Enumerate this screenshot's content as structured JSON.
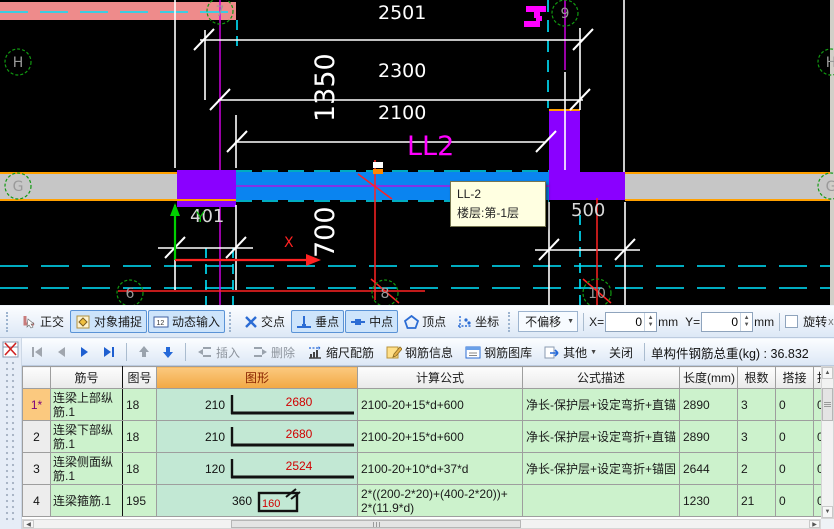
{
  "drawing": {
    "grid_labels": {
      "H_left": "H",
      "G_left": "G",
      "H_right": "H",
      "G_right": "G",
      "c6": "6",
      "c7": "7",
      "c8": "8",
      "c9": "9",
      "c10": "10"
    },
    "dimensions": {
      "top1": "2501",
      "top2": "2300",
      "top3": "2100",
      "vert1": "1350",
      "vert2": "700",
      "col_left": "401",
      "col_right": "500"
    },
    "beam_label": "LL2",
    "axis": {
      "x": "X",
      "y": "Y"
    },
    "tooltip": {
      "line1": "LL-2",
      "line2": "楼层:第-1层"
    },
    "colors": {
      "beam": "#0a84f0",
      "column": "#8a00ff",
      "wall": "#c6c6c6",
      "highlight_band": "#ee8b8b",
      "edge_orange": "#ffa000",
      "centerline": "#cc00dd",
      "label_magenta": "#ff00ff",
      "grid_green": "#119911",
      "dim_red": "#ff2222",
      "cyan": "#00e5ff"
    }
  },
  "snap_toolbar": {
    "ortho": "正交",
    "object_snap": "对象捕捉",
    "dynamic_input": "动态输入",
    "dynamic_input_icon_text": "12",
    "intersection": "交点",
    "perpendicular": "垂点",
    "midpoint": "中点",
    "vertex": "顶点",
    "coordinate": "坐标",
    "offset_mode": "不偏移",
    "x_label": "X=",
    "x_value": "0",
    "y_label": "Y=",
    "y_value": "0",
    "unit": "mm",
    "rotate": "旋转",
    "overflow": "x"
  },
  "edit_toolbar": {
    "insert": "插入",
    "delete": "删除",
    "scale_rebar": "缩尺配筋",
    "rebar_info": "钢筋信息",
    "rebar_library": "钢筋图库",
    "other": "其他",
    "close": "关闭",
    "total_weight": "单构件钢筋总重(kg) : 36.832"
  },
  "table": {
    "headers": {
      "num": "",
      "name": "筋号",
      "shape_no": "图号",
      "shape": "图形",
      "formula": "计算公式",
      "formula_desc": "公式描述",
      "length": "长度(mm)",
      "count": "根数",
      "lap": "搭接",
      "overflow": "损"
    },
    "rows": [
      {
        "num": "1*",
        "name": "连梁上部纵筋.1",
        "shape_no": "18",
        "shape_left": "210",
        "shape_len": "2680",
        "formula": "2100-20+15*d+600",
        "formula2": "",
        "desc": "净长-保护层+设定弯折+直锚",
        "length": "2890",
        "count": "3",
        "lap": "0",
        "overflow": "0"
      },
      {
        "num": "2",
        "name": "连梁下部纵筋.1",
        "shape_no": "18",
        "shape_left": "210",
        "shape_len": "2680",
        "formula": "2100-20+15*d+600",
        "formula2": "",
        "desc": "净长-保护层+设定弯折+直锚",
        "length": "2890",
        "count": "3",
        "lap": "0",
        "overflow": "0"
      },
      {
        "num": "3",
        "name": "连梁侧面纵筋.1",
        "shape_no": "18",
        "shape_left": "120",
        "shape_len": "2524",
        "formula": "2100-20+10*d+37*d",
        "formula2": "",
        "desc": "净长-保护层+设定弯折+锚固",
        "length": "2644",
        "count": "2",
        "lap": "0",
        "overflow": "0"
      },
      {
        "num": "4",
        "name": "连梁箍筋.1",
        "shape_no": "195",
        "shape_left": "360",
        "shape_len": "160",
        "formula": "2*((200-2*20)+(400-2*20))+",
        "formula2": "2*(11.9*d)",
        "desc": "",
        "length": "1230",
        "count": "21",
        "lap": "0",
        "overflow": "0"
      }
    ]
  }
}
